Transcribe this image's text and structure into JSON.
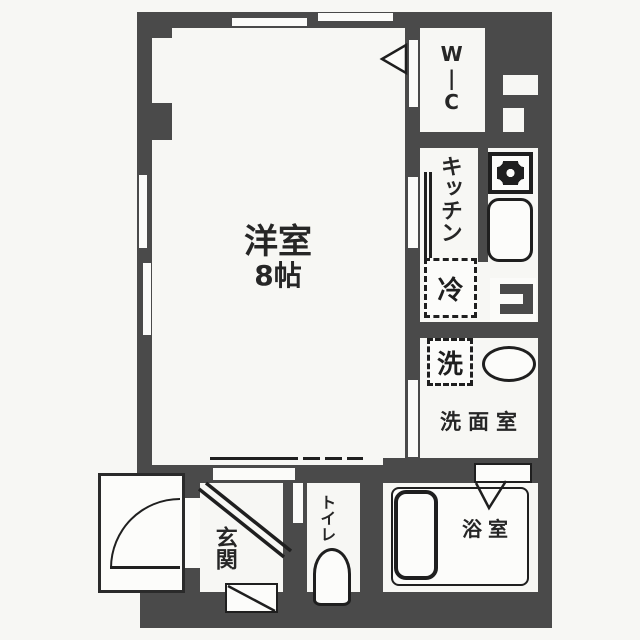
{
  "plan": {
    "type": "apartment-floor-plan",
    "rooms": {
      "main_room": {
        "name": "洋室",
        "size": "8帖"
      },
      "wic": {
        "name": "W|C"
      },
      "kitchen": {
        "name": "キッチン"
      },
      "washroom": {
        "name": "洗面室"
      },
      "bathroom": {
        "name": "浴室"
      },
      "toilet": {
        "name": "トイレ"
      },
      "entrance": {
        "name": "玄関"
      }
    },
    "fixtures": {
      "refrigerator": {
        "label": "冷"
      },
      "washing_machine": {
        "label": "洗"
      }
    },
    "colors": {
      "wall": "#4a4a4a",
      "line": "#1f1f1f",
      "background": "#f7f7f4",
      "floor": "#fcfcfa"
    }
  }
}
